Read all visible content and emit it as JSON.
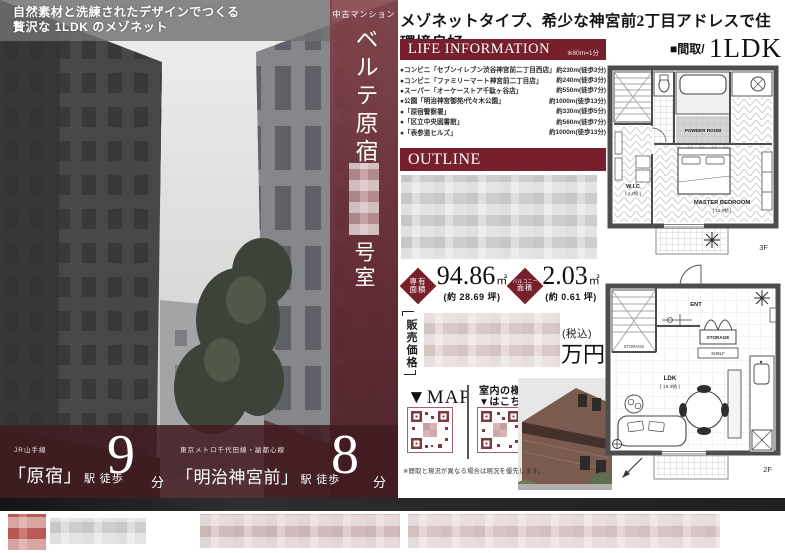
{
  "hero": {
    "tagline_line1": "自然素材と洗練されたデザインでつくる",
    "tagline_line2": "贅沢な 1LDK のメゾネット",
    "property_type": "中古マンション",
    "property_name": "ベルテ原宿",
    "room_suffix": "号室"
  },
  "headline": "メゾネットタイプ、希少な神宮前2丁目アドレスで住環境良好",
  "life_information": {
    "title": "LIFE INFORMATION",
    "note": "※80m=1分",
    "items": [
      {
        "name": "●コンビニ「セブンイレブン渋谷神宮前二丁目西店」",
        "distance": "約230m(徒歩3分)"
      },
      {
        "name": "●コンビニ「ファミリーマート神宮前二丁目店」",
        "distance": "約240m(徒歩3分)"
      },
      {
        "name": "●スーパー「オーケーストア千駄ヶ谷店」",
        "distance": "約550m(徒歩7分)"
      },
      {
        "name": "●公園「明治神宮御苑/代々木公園」",
        "distance": "約1000m(徒歩13分)"
      },
      {
        "name": "●「原宿警察署」",
        "distance": "約330m(徒歩5分)"
      },
      {
        "name": "●「区立中央図書館」",
        "distance": "約560m(徒歩7分)"
      },
      {
        "name": "●「表参道ヒルズ」",
        "distance": "約1000m(徒歩13分)"
      }
    ]
  },
  "outline": {
    "title": "OUTLINE"
  },
  "area": {
    "exclusive": {
      "label1": "専有",
      "label2": "面積",
      "value": "94.86",
      "unit": "㎡",
      "tsubo": "(約 28.69 坪)"
    },
    "balcony": {
      "label1": "バルコニー",
      "label2": "面積",
      "value": "2.03",
      "unit": "㎡",
      "tsubo": "(約 0.61 坪)"
    }
  },
  "price": {
    "label": "販売価格",
    "tax_note": "(税込)",
    "unit": "万円"
  },
  "qr": {
    "map_label": "▼MAP",
    "interior_line1": "室内の様子",
    "interior_line2": "▼はこちら"
  },
  "disclaimer": "※間取と現況が異なる場合は現況を優先します。",
  "floorplan": {
    "header_label": "■間取/",
    "header_type": "1LDK",
    "floor3": "3F",
    "floor2": "2F",
    "rooms": {
      "master_bedroom": "MASTER BEDROOM",
      "master_bedroom_size": "[ 10.6帖 ]",
      "wic": "W.I.C",
      "wic_size": "[ 4.2帖 ]",
      "powder_room": "POWDER ROOM",
      "ldk": "LDK",
      "ldk_size": "[ 15.4帖 ]",
      "ent": "ENT",
      "storage": "STORAGE",
      "shelf": "SHELF",
      "stair_storage": "STORAGE"
    }
  },
  "access": [
    {
      "line": "JR山手線",
      "station": "「原宿」",
      "suffix": "駅 徒歩",
      "minutes": "9",
      "unit": "分"
    },
    {
      "line": "東京メトロ千代田線・副都心線",
      "station": "「明治神宮前」",
      "suffix": "駅 徒歩",
      "minutes": "8",
      "unit": "分"
    }
  ]
}
